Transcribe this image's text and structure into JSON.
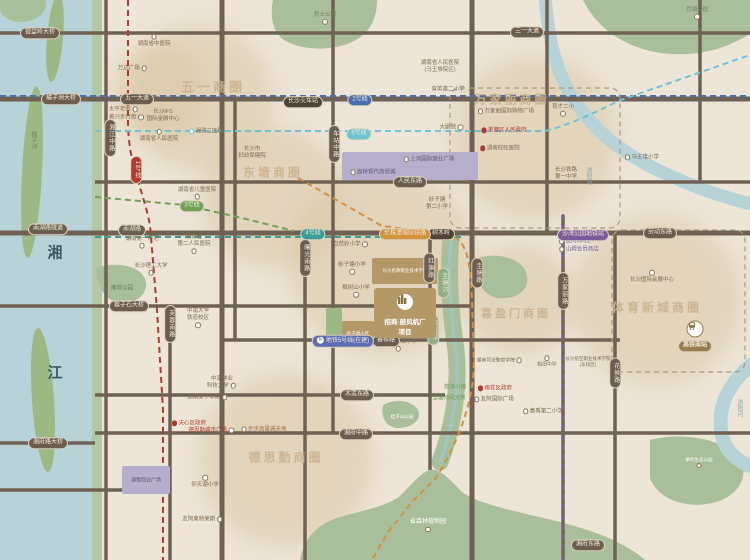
{
  "canvas": {
    "w": 750,
    "h": 560
  },
  "palette": {
    "bg": "#ece5d8",
    "water": "#b7d3d7",
    "bank": "#b5c8a4",
    "island": "#9db885",
    "park": "#a9bf9b",
    "road": "#6f6255",
    "blob": "#d9c6a2",
    "pill_bg": "#6b5e50",
    "station_bg": "#4e4337",
    "hsr_bg": "#9a7d4f",
    "boundary": "#a89a82",
    "metro1": "#b23a32",
    "metro2": "#4a6fae",
    "metro3": "#71a257",
    "metro4": "#3a9e98",
    "metro5": "#7d5c9e",
    "metro6": "#6fc3d4",
    "metro5b": "#5d6cb3",
    "intercity": "#d4913f",
    "gov_red": "#b03a30",
    "green_text": "#6a9a5c",
    "river_text": "#7aa8b5",
    "purple_block": "#b7aecb",
    "tan_block": "#b49867"
  },
  "geo": {
    "blobs": [
      {
        "cx": 200,
        "cy": 98,
        "r": 74
      },
      {
        "cx": 273,
        "cy": 198,
        "r": 72
      },
      {
        "cx": 382,
        "cy": 262,
        "r": 95
      },
      {
        "cx": 535,
        "cy": 138,
        "r": 84
      },
      {
        "cx": 520,
        "cy": 300,
        "r": 56
      },
      {
        "cx": 657,
        "cy": 300,
        "r": 86
      },
      {
        "cx": 286,
        "cy": 460,
        "r": 88
      },
      {
        "cx": 160,
        "cy": 92,
        "r": 48
      }
    ],
    "water_rects": [
      {
        "x": 0,
        "y": 0,
        "w": 92,
        "h": 560,
        "fill": "water"
      },
      {
        "x": 92,
        "y": 0,
        "w": 10,
        "h": 560,
        "fill": "bank"
      }
    ],
    "islands": [
      {
        "cx": 55,
        "cy": 38,
        "rx": 8,
        "ry": 44,
        "rot": 5
      },
      {
        "cx": 32,
        "cy": 172,
        "rx": 10,
        "ry": 86,
        "rot": 3
      },
      {
        "cx": 43,
        "cy": 400,
        "rx": 11,
        "ry": 72,
        "rot": -4
      }
    ],
    "park_paths": [
      {
        "d": "M273,0 L377,0 C377,18 370,34 352,42 C330,52 300,50 284,40 C272,32 270,14 273,0 Z"
      },
      {
        "d": "M583,0 L750,0 L750,34 C720,52 690,58 655,52 C625,46 598,30 583,0 Z"
      },
      {
        "d": "M0,0 L46,0 C48,10 40,20 24,22 C10,23 0,16 0,8 Z"
      },
      {
        "d": "M96,268 C112,262 132,264 142,274 C150,284 146,298 130,302 C112,306 98,296 96,268 Z"
      },
      {
        "d": "M383,405 C395,398 412,400 418,410 C422,420 412,428 398,428 C386,428 380,416 383,405 Z"
      },
      {
        "d": "M478,258 C498,252 520,258 526,272 C532,288 518,300 498,298 C482,296 472,276 478,258 Z"
      },
      {
        "d": "M650,440 C680,432 720,438 738,456 C750,472 742,494 716,502 C688,510 658,500 650,478 Z"
      },
      {
        "d": "M300,560 C304,540 314,527 334,519 C358,511 384,508 400,496 C410,486 418,476 427,471 C438,465 450,480 462,492 C480,505 520,512 560,522 C600,532 628,545 645,560 Z"
      }
    ],
    "guitang_river": {
      "d": "M451,238 C448,270 450,310 456,350 C460,390 452,430 440,462",
      "stroke": "park",
      "sw": 17,
      "inner": "#9fc6c8",
      "isw": 3
    },
    "liuyang_river": [
      {
        "d": "M545,-6 C548,40 556,72 574,100 C596,134 626,155 662,172 C696,188 722,197 755,205",
        "sw": 13
      },
      {
        "d": "M755,362 C728,382 716,408 722,436 C726,452 738,462 755,468",
        "sw": 14
      }
    ],
    "roads_h": [
      {
        "y": 33,
        "x1": 0,
        "x2": 750
      },
      {
        "y": 99,
        "x1": 0,
        "x2": 750,
        "w": 5
      },
      {
        "y": 182,
        "x1": 95,
        "x2": 750
      },
      {
        "y": 233,
        "x1": 0,
        "x2": 750,
        "w": 5
      },
      {
        "y": 306,
        "x1": 0,
        "x2": 470
      },
      {
        "y": 340,
        "x1": 220,
        "x2": 620
      },
      {
        "y": 395,
        "x1": 95,
        "x2": 445
      },
      {
        "y": 433,
        "x1": 95,
        "x2": 750
      },
      {
        "y": 443,
        "x1": 0,
        "x2": 95
      },
      {
        "y": 490,
        "x1": 0,
        "x2": 168
      }
    ],
    "roads_v": [
      {
        "x": 106,
        "y1": 0,
        "y2": 560
      },
      {
        "x": 170,
        "y1": 306,
        "y2": 560
      },
      {
        "x": 222,
        "y1": 0,
        "y2": 560,
        "w": 5
      },
      {
        "x": 235,
        "y1": 99,
        "y2": 340
      },
      {
        "x": 305,
        "y1": 233,
        "y2": 560
      },
      {
        "x": 333,
        "y1": 0,
        "y2": 433
      },
      {
        "x": 430,
        "y1": 233,
        "y2": 470
      },
      {
        "x": 472,
        "y1": 0,
        "y2": 560,
        "w": 5
      },
      {
        "x": 547,
        "y1": 0,
        "y2": 233
      },
      {
        "x": 563,
        "y1": 215,
        "y2": 560
      },
      {
        "x": 615,
        "y1": 233,
        "y2": 560
      },
      {
        "x": 700,
        "y1": 0,
        "y2": 182
      }
    ],
    "metro_paths": [
      {
        "name": "line-1",
        "color": "metro1",
        "d": "M128,0 L128,120 C128,165 142,185 150,225 L157,310 L163,410 L163,560"
      },
      {
        "name": "line-2",
        "color": "metro2",
        "d": "M0,96 L750,96"
      },
      {
        "name": "line-6",
        "color": "metro6",
        "d": "M95,131 L545,131 C572,124 594,113 618,101 L750,55"
      },
      {
        "name": "line-3",
        "color": "metro3",
        "d": "M95,197 L185,205 L242,218 L294,231"
      },
      {
        "name": "line-4",
        "color": "metro4",
        "d": "M95,237 L462,237"
      },
      {
        "name": "line-5",
        "color": "metro5",
        "d": "M563,214 L563,560"
      },
      {
        "name": "intercity-rail",
        "color": "intercity",
        "d": "M298,178 L382,226 L450,235 C468,241 470,262 472,300 L474,360 C474,402 458,442 436,478 L412,502 L388,532 L372,560"
      }
    ],
    "district_boxes": [
      {
        "x": 450,
        "y": 88,
        "w": 170,
        "h": 140
      },
      {
        "x": 612,
        "y": 230,
        "w": 133,
        "h": 142
      }
    ]
  },
  "blocks": [
    {
      "x": 342,
      "y": 152,
      "w": 136,
      "h": 28,
      "fill": "purple_block"
    },
    {
      "x": 122,
      "y": 466,
      "w": 48,
      "h": 28,
      "fill": "purple_block",
      "label": "通程商业广场",
      "lc": "#5c5470",
      "ls": 5
    },
    {
      "x": 372,
      "y": 258,
      "w": 66,
      "h": 26,
      "fill": "tan_block",
      "label": "长沙民政职业技术学院",
      "lc": "#ffffff",
      "ls": 4.5
    },
    {
      "x": 342,
      "y": 321,
      "w": 32,
      "h": 25,
      "fill": "tan_block",
      "label": "砂子塘小区",
      "lc": "#ffffff",
      "ls": 4.5
    },
    {
      "x": 326,
      "y": 308,
      "w": 16,
      "h": 38,
      "fill": "island"
    }
  ],
  "project": {
    "x": 374,
    "y": 288,
    "w": 62,
    "h": 50,
    "fill": "#b49867",
    "line1": "招商·鼓风机厂",
    "line2": "项目",
    "icon": "building-icon"
  },
  "hsr_station": {
    "pill": "高铁南站",
    "x": 695,
    "pill_y": 346,
    "icon_x": 695,
    "icon_y": 329
  },
  "business_circles": [
    {
      "t": "五一商圈",
      "x": 213,
      "y": 86,
      "s": 13
    },
    {
      "t": "东塘商圈",
      "x": 273,
      "y": 172,
      "s": 12
    },
    {
      "t": "万家丽商圈",
      "x": 512,
      "y": 99,
      "s": 12
    },
    {
      "t": "喜盈门商圈",
      "x": 516,
      "y": 313,
      "s": 11
    },
    {
      "t": "体育新城商圈",
      "x": 657,
      "y": 307,
      "s": 12
    },
    {
      "t": "德思勤商圈",
      "x": 286,
      "y": 457,
      "s": 12
    }
  ],
  "pills": [
    {
      "t": "银盆岭大桥",
      "x": 40,
      "y": 33,
      "k": "bridge"
    },
    {
      "t": "三一大道",
      "x": 527,
      "y": 32,
      "k": "road"
    },
    {
      "t": "橘子洲大桥",
      "x": 61,
      "y": 99,
      "k": "bridge"
    },
    {
      "t": "五一大道",
      "x": 137,
      "y": 99,
      "k": "road"
    },
    {
      "t": "长沙火车站",
      "x": 303,
      "y": 102,
      "k": "station",
      "bg": "station_bg"
    },
    {
      "t": "人民东路",
      "x": 410,
      "y": 182,
      "k": "road"
    },
    {
      "t": "南湖路隧道",
      "x": 48,
      "y": 229,
      "k": "bridge"
    },
    {
      "t": "南湖路",
      "x": 132,
      "y": 230,
      "k": "road"
    },
    {
      "t": "劳动东路",
      "x": 660,
      "y": 233,
      "k": "road"
    },
    {
      "t": "树木岭",
      "x": 441,
      "y": 234,
      "k": "station",
      "bg": "station_bg"
    },
    {
      "t": "猴子石大桥",
      "x": 129,
      "y": 306,
      "k": "bridge"
    },
    {
      "t": "香樟路",
      "x": 386,
      "y": 341,
      "k": "road"
    },
    {
      "t": "木莲东路",
      "x": 357,
      "y": 395,
      "k": "road"
    },
    {
      "t": "湘府中路",
      "x": 356,
      "y": 434,
      "k": "road"
    },
    {
      "t": "湘府路大桥",
      "x": 48,
      "y": 443,
      "k": "bridge"
    },
    {
      "t": "湘府东路",
      "x": 588,
      "y": 545,
      "k": "road"
    },
    {
      "t": "湘江中路",
      "x": 110,
      "y": 138,
      "k": "road",
      "v": true
    },
    {
      "t": "车站中路",
      "x": 334,
      "y": 144,
      "k": "road",
      "v": true
    },
    {
      "t": "曙光南路",
      "x": 305,
      "y": 258,
      "k": "road",
      "v": true
    },
    {
      "t": "红旗路",
      "x": 429,
      "y": 268,
      "k": "road",
      "v": true
    },
    {
      "t": "圭塘路",
      "x": 477,
      "y": 273,
      "k": "road",
      "v": true
    },
    {
      "t": "万家丽路",
      "x": 563,
      "y": 291,
      "k": "road",
      "v": true
    },
    {
      "t": "芙蓉南路",
      "x": 170,
      "y": 324,
      "k": "road",
      "v": true
    },
    {
      "t": "花侯路",
      "x": 615,
      "y": 373,
      "k": "road",
      "v": true
    },
    {
      "t": "1号线",
      "x": 136,
      "y": 170,
      "k": "metro",
      "bg": "metro1",
      "v": true
    },
    {
      "t": "2号线",
      "x": 360,
      "y": 100,
      "k": "metro",
      "bg": "metro2"
    },
    {
      "t": "6号线",
      "x": 359,
      "y": 134,
      "k": "metro",
      "bg": "metro6"
    },
    {
      "t": "3号线",
      "x": 192,
      "y": 206,
      "k": "metro",
      "bg": "metro3"
    },
    {
      "t": "4号线",
      "x": 313,
      "y": 234,
      "k": "metro",
      "bg": "metro4"
    },
    {
      "t": "长株潭城际铁路",
      "x": 405,
      "y": 234,
      "k": "metro",
      "bg": "intercity"
    },
    {
      "t": "沙湾公园地铁站",
      "x": 583,
      "y": 235,
      "k": "metro",
      "bg": "metro5"
    },
    {
      "t": "地铁5号线(在建)",
      "x": 343,
      "y": 341,
      "k": "metro",
      "bg": "metro5b",
      "prefix": "5"
    },
    {
      "t": "圭塘河",
      "x": 443,
      "y": 283,
      "k": "river",
      "bg": "#8fae83",
      "v": true
    },
    {
      "t": "风光带",
      "x": 433,
      "y": 330,
      "k": "river",
      "bg": "#8fae83",
      "v": true
    }
  ],
  "pois": [
    {
      "t": "湖南省中医院",
      "x": 154,
      "y": 41,
      "dot": "a"
    },
    {
      "t": "万达广场",
      "x": 133,
      "y": 69,
      "dot": "r"
    },
    {
      "t": "太平老街",
      "x": 124,
      "y": 110,
      "dot": "r"
    },
    {
      "t": "黄兴步行街",
      "x": 127,
      "y": 118,
      "dot": "r"
    },
    {
      "lines": [
        "长沙IFS",
        "国际金融中心"
      ],
      "x": 163,
      "y": 116
    },
    {
      "t": "湖南省人民医院",
      "x": 159,
      "y": 136,
      "dot": "a"
    },
    {
      "t": "湘雅二医院",
      "x": 205,
      "y": 132,
      "dot": "l",
      "dotc": "#6fc3d4"
    },
    {
      "t": "烈士公园",
      "x": 325,
      "y": 19,
      "c": "#6b7d5a",
      "dot": "b"
    },
    {
      "t": "月湖公园",
      "x": 697,
      "y": 14,
      "c": "#6b7d5a",
      "dot": "b"
    },
    {
      "lines": [
        "湖南省人民医院",
        "(马王堆院区)"
      ],
      "x": 440,
      "y": 67
    },
    {
      "t": "育英第二小学",
      "x": 448,
      "y": 90
    },
    {
      "t": "大剧院",
      "x": 452,
      "y": 128,
      "dot": "r"
    },
    {
      "t": "万家丽国际购物广场",
      "x": 505,
      "y": 112,
      "dot": "l"
    },
    {
      "t": "芙蓉区人民政府",
      "x": 503,
      "y": 131,
      "c": "#b03a30",
      "dot": "l",
      "dotc": "#b03a30",
      "fill": true
    },
    {
      "t": "湖南旺旺医院",
      "x": 499,
      "y": 149,
      "dot": "l",
      "dotc": "#b03a30",
      "fill": true
    },
    {
      "t": "育才二小",
      "x": 563,
      "y": 111,
      "dot": "b"
    },
    {
      "t": "马王堆小学",
      "x": 641,
      "y": 158,
      "dot": "l"
    },
    {
      "lines": [
        "长沙铁路",
        "第一中学"
      ],
      "x": 566,
      "y": 174
    },
    {
      "lines": [
        "长沙市",
        "妇幼保健院"
      ],
      "x": 252,
      "y": 153
    },
    {
      "t": "湖南省儿童医院",
      "x": 197,
      "y": 194,
      "dot": "b"
    },
    {
      "lines": [
        "湖南省",
        "第二人民医院"
      ],
      "x": 194,
      "y": 245,
      "dot": "b"
    },
    {
      "t": "湖南第一师范",
      "x": 142,
      "y": 243,
      "dot": "b"
    },
    {
      "t": "长沙理工大学",
      "x": 151,
      "y": 270,
      "dot": "b"
    },
    {
      "t": "南郊公园",
      "x": 122,
      "y": 289,
      "c": "#5d7a4d"
    },
    {
      "lines": [
        "中南大学",
        "铁道校区"
      ],
      "x": 198,
      "y": 319,
      "dot": "b"
    },
    {
      "t": "自然岭小学",
      "x": 351,
      "y": 245,
      "dot": "r"
    },
    {
      "t": "砂子塘小学",
      "x": 352,
      "y": 269,
      "dot": "b"
    },
    {
      "lines": [
        "砂子塘",
        "第二小学"
      ],
      "x": 437,
      "y": 204
    },
    {
      "t": "枫树山小学",
      "x": 356,
      "y": 292,
      "dot": "b"
    },
    {
      "t": "枫树山第二小学",
      "x": 398,
      "y": 346,
      "dot": "b"
    },
    {
      "t": "桂子山公园",
      "x": 402,
      "y": 417,
      "c": "#ffffff",
      "s": 4.5
    },
    {
      "t": "悠游小镇",
      "x": 455,
      "y": 388,
      "c": "#6a9a5c"
    },
    {
      "t": "圭塘河风光带",
      "x": 449,
      "y": 399,
      "c": "#6a9a5c"
    },
    {
      "t": "上河国际商业广场",
      "x": 428,
      "y": 160,
      "c": "#5c5470",
      "dot": "l"
    },
    {
      "t": "高桥现代商贸城",
      "x": 372,
      "y": 173,
      "c": "#5c5470",
      "dot": "l"
    },
    {
      "t": "友阿MALL",
      "x": 574,
      "y": 242,
      "c": "#7d5c9e",
      "dot": "l"
    },
    {
      "t": "山姆会员商店",
      "x": 578,
      "y": 250,
      "c": "#7d5c9e",
      "dot": "l"
    },
    {
      "t": "长沙国际会展中心",
      "x": 652,
      "y": 277,
      "dot": "a"
    },
    {
      "t": "湖南司法警官学院",
      "x": 500,
      "y": 361,
      "dot": "r",
      "s": 4.8
    },
    {
      "t": "稻田中学",
      "x": 547,
      "y": 362,
      "dot": "a",
      "s": 4.8
    },
    {
      "lines": [
        "长沙航空职业技术学院",
        "(东校区)"
      ],
      "x": 588,
      "y": 362,
      "s": 4.5
    },
    {
      "t": "雨花区政府",
      "x": 494,
      "y": 389,
      "c": "#b03a30",
      "dot": "l",
      "dotc": "#b03a30",
      "fill": true
    },
    {
      "t": "友阿国际广场",
      "x": 493,
      "y": 400,
      "dot": "l"
    },
    {
      "t": "泰禹第二小学",
      "x": 542,
      "y": 412,
      "dot": "l"
    },
    {
      "t": "天心区政府",
      "x": 188,
      "y": 424,
      "c": "#b03a30",
      "dot": "l",
      "dotc": "#b03a30",
      "fill": true
    },
    {
      "t": "德思勤城市广场",
      "x": 212,
      "y": 431,
      "c": "#b03a30",
      "dot": "r"
    },
    {
      "t": "步步高星城天地",
      "x": 263,
      "y": 430,
      "c": "#a5683a",
      "dot": "l"
    },
    {
      "lines": [
        "中南林业",
        "科技大学"
      ],
      "x": 222,
      "y": 383,
      "dot": "r"
    },
    {
      "t": "湖南女子学院",
      "x": 208,
      "y": 398,
      "dot": "r"
    },
    {
      "t": "仰天湖小学",
      "x": 205,
      "y": 482,
      "dot": "a"
    },
    {
      "t": "友阿奥特莱斯",
      "x": 203,
      "y": 520,
      "dot": "r"
    },
    {
      "t": "黎托生态公园",
      "x": 699,
      "y": 463,
      "c": "#ffffff",
      "s": 4.5,
      "dot": "b"
    },
    {
      "t": "省森林植物园",
      "x": 428,
      "y": 527,
      "c": "#ffffff",
      "s": 6,
      "dot": "b"
    },
    {
      "t": "湘",
      "x": 55,
      "y": 253,
      "c": "#3d5a64",
      "s": 15,
      "bold": true
    },
    {
      "t": "江",
      "x": 55,
      "y": 373,
      "c": "#3d5a64",
      "s": 15,
      "bold": true
    },
    {
      "t": "浏阳河",
      "x": 587,
      "y": 176,
      "c": "#7aa8b5",
      "v": true,
      "s": 6
    },
    {
      "t": "浏阳河",
      "x": 738,
      "y": 408,
      "c": "#7aa8b5",
      "v": true,
      "s": 6
    },
    {
      "t": "橘子洲",
      "x": 32,
      "y": 140,
      "c": "#6b8a5a",
      "v": true,
      "s": 6
    }
  ]
}
